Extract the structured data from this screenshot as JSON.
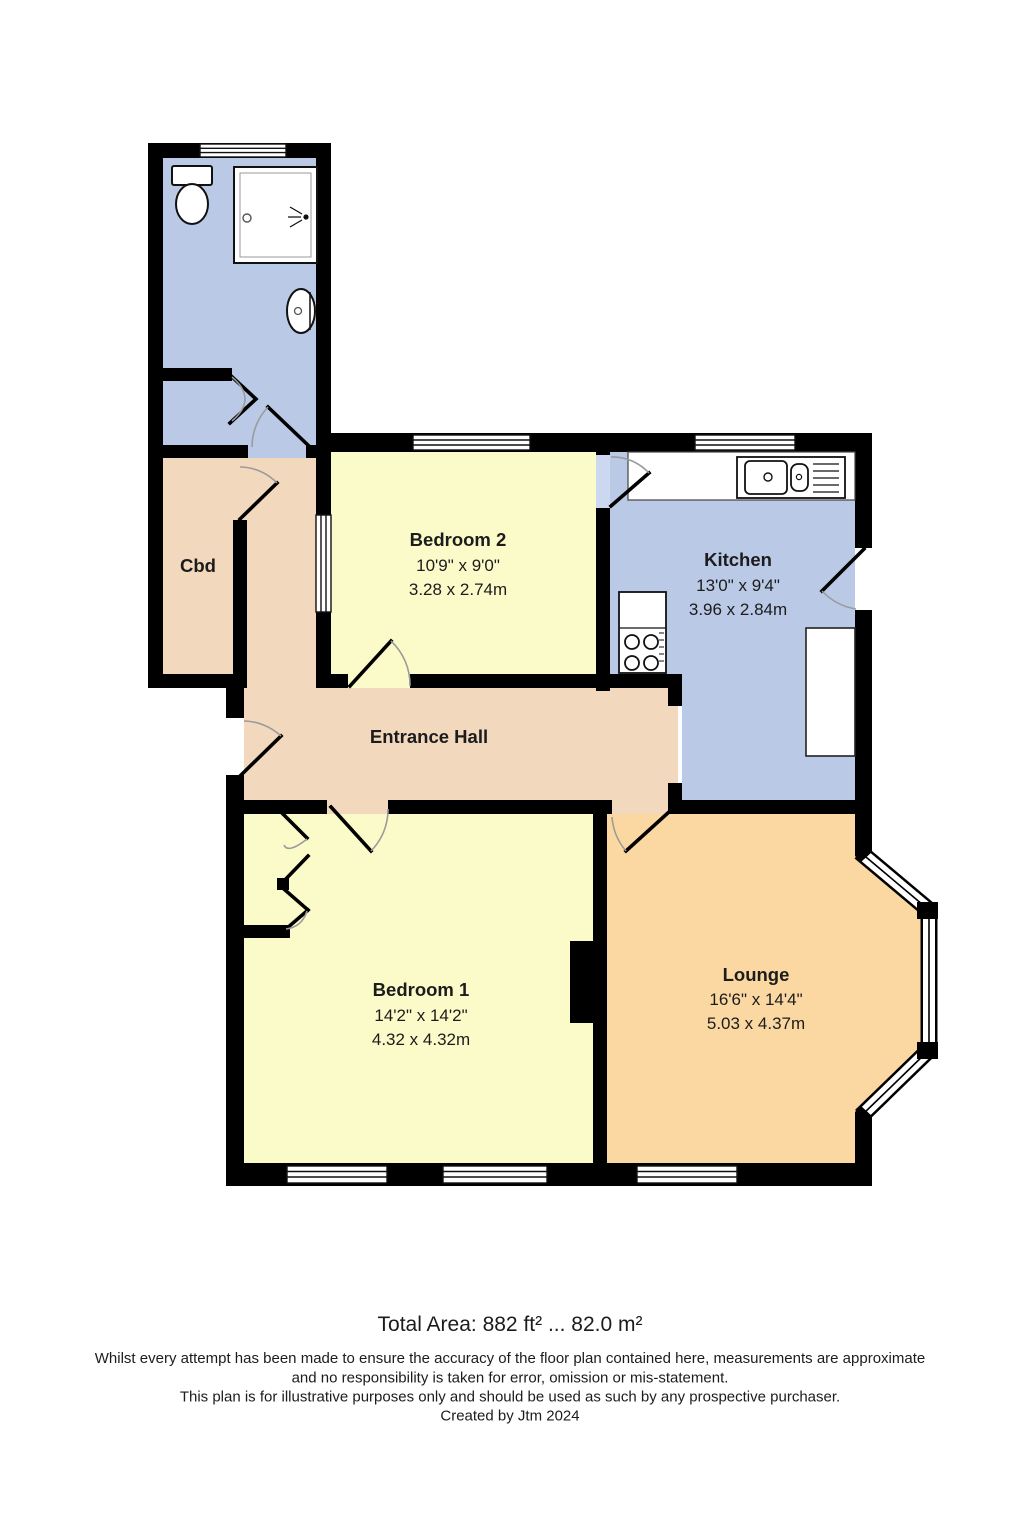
{
  "rooms": {
    "cbd": {
      "name": "Cbd"
    },
    "entrance_hall": {
      "name": "Entrance Hall"
    },
    "bedroom2": {
      "name": "Bedroom 2",
      "size_imperial": "10'9\" x 9'0\"",
      "size_metric": "3.28 x 2.74m"
    },
    "kitchen": {
      "name": "Kitchen",
      "size_imperial": "13'0\" x 9'4\"",
      "size_metric": "3.96 x 2.84m"
    },
    "bedroom1": {
      "name": "Bedroom 1",
      "size_imperial": "14'2\" x 14'2\"",
      "size_metric": "4.32 x 4.32m"
    },
    "lounge": {
      "name": "Lounge",
      "size_imperial": "16'6\" x 14'4\"",
      "size_metric": "5.03 x 4.37m"
    }
  },
  "footer": {
    "total_area": "Total Area: 882 ft² ... 82.0 m²",
    "disclaimer_1": "Whilst every attempt has been made to ensure the accuracy of the floor plan contained here, measurements are approximate",
    "disclaimer_2": "and no responsibility is taken for error, omission or mis-statement.",
    "disclaimer_3": "This plan is for illustrative purposes only and should be used as such by any prospective purchaser.",
    "credit": "Created by Jtm 2024"
  },
  "colors": {
    "wall": "#000000",
    "bathroom_fill": "#b9c9e6",
    "kitchen_fill": "#b9c9e6",
    "hall_fill": "#f2d8bd",
    "bedroom_fill": "#fbfbca",
    "lounge_fill": "#fbd8a2",
    "door_recess_fill": "#ccd8ef"
  }
}
